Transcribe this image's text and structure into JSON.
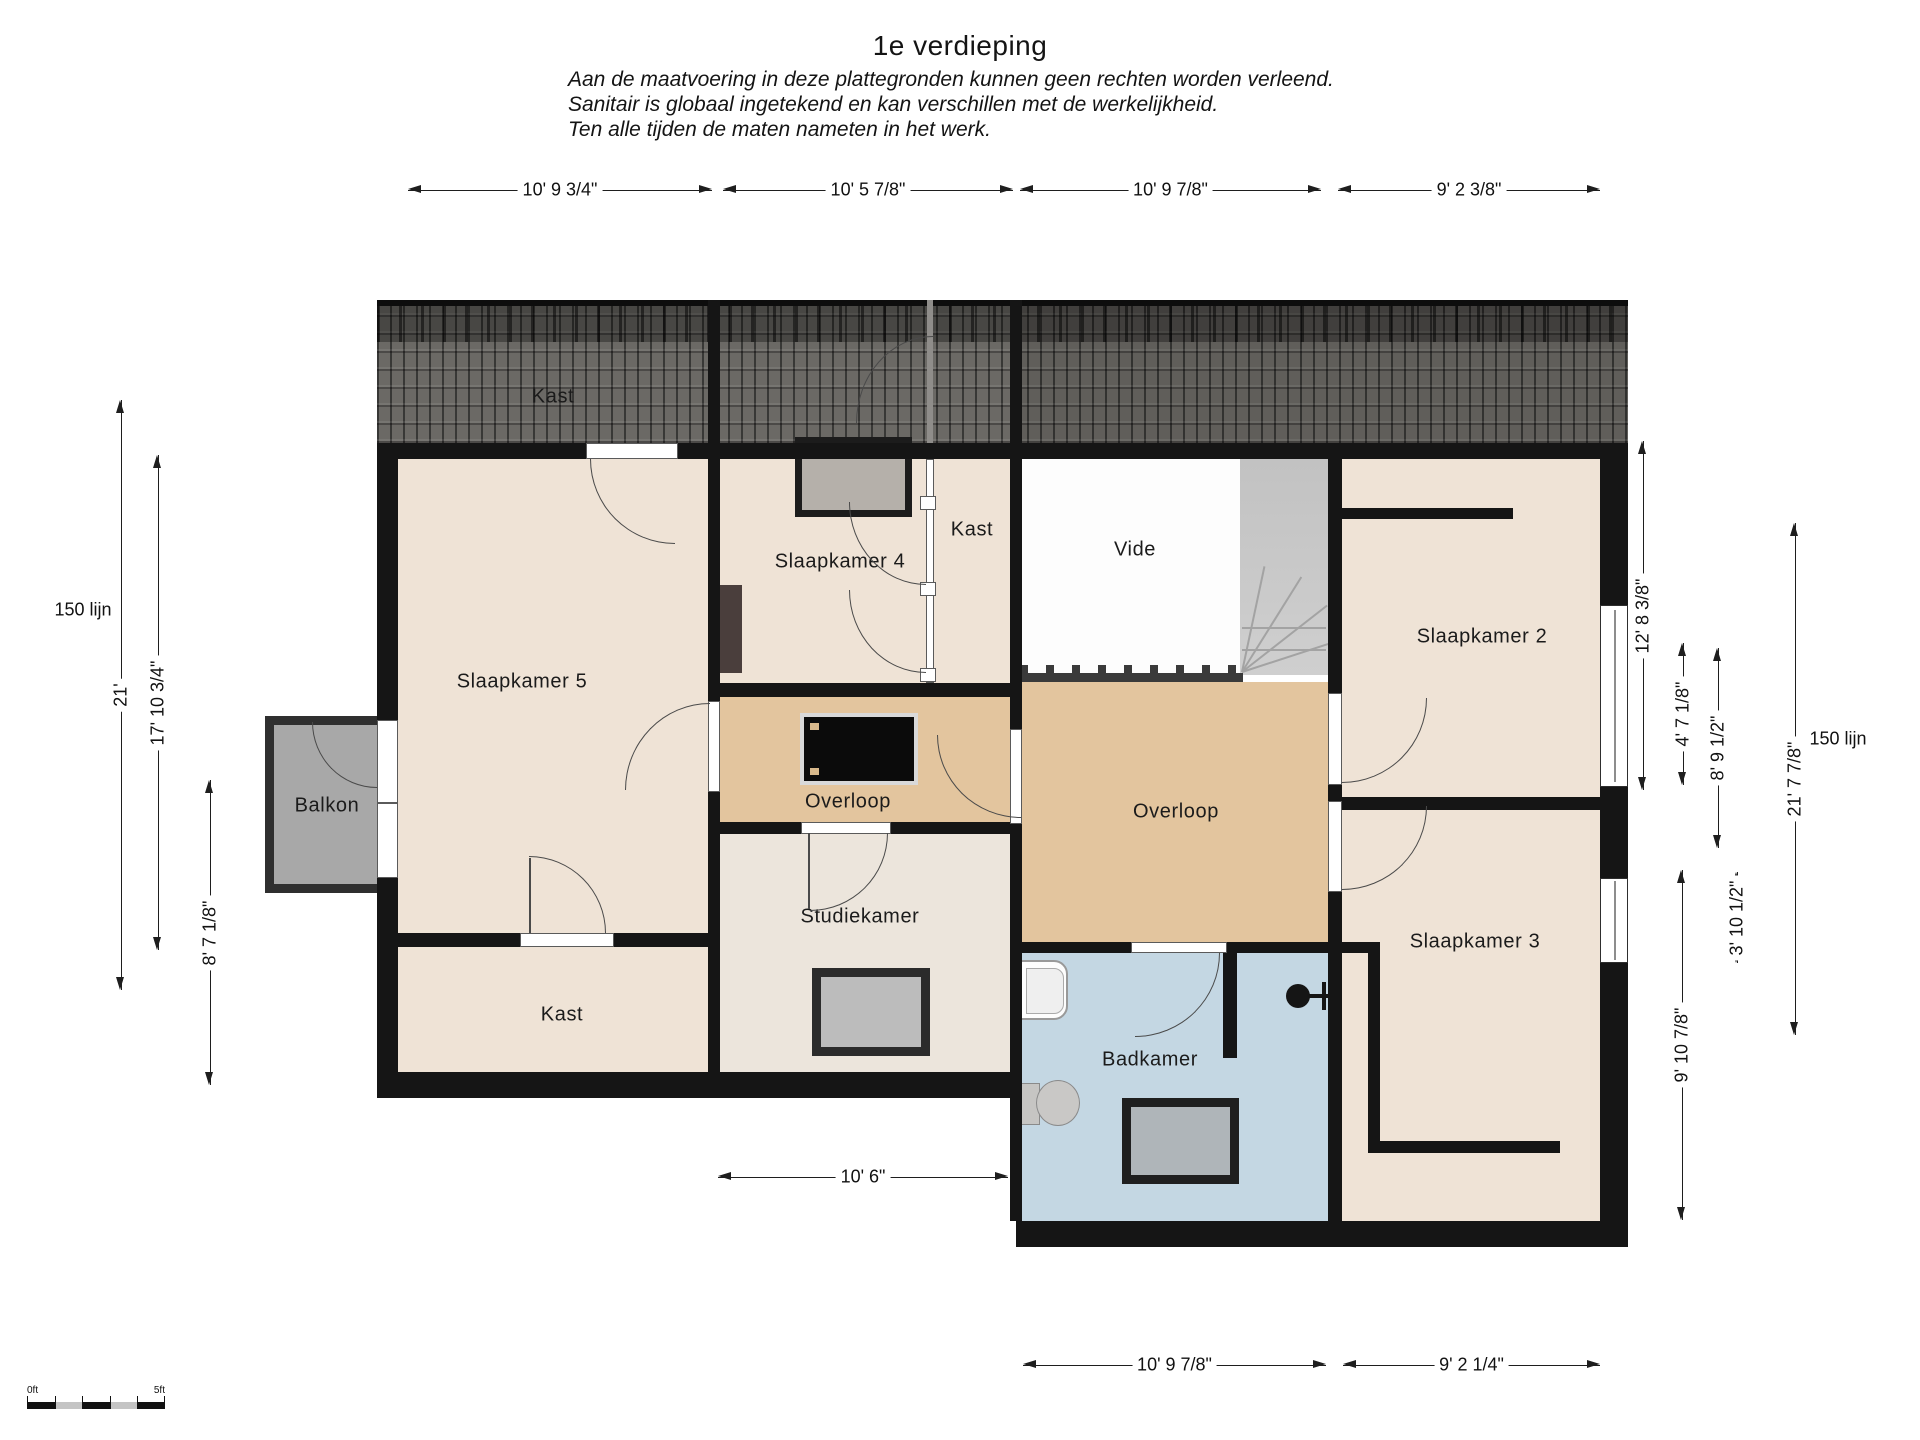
{
  "title": "1e verdieping",
  "disclaimer": {
    "line1": "Aan de maatvoering in deze plattegronden kunnen geen rechten worden verleend.",
    "line2": "Sanitair is globaal ingetekend en kan verschillen met de werkelijkheid.",
    "line3": "Ten alle tijden de maten nameten in het werk."
  },
  "rooms": {
    "roof_closet": "Kast",
    "bedroom5": "Slaapkamer 5",
    "bedroom4": "Slaapkamer 4",
    "closet_top": "Kast",
    "void": "Vide",
    "bedroom2": "Slaapkamer 2",
    "landing_left": "Overloop",
    "landing_right": "Overloop",
    "study": "Studiekamer",
    "closet_bottom": "Kast",
    "balcony": "Balkon",
    "bathroom": "Badkamer",
    "bedroom3": "Slaapkamer 3"
  },
  "dimensions": {
    "top": [
      {
        "id": "t1",
        "label": "10' 9 3/4\""
      },
      {
        "id": "t2",
        "label": "10' 5 7/8\""
      },
      {
        "id": "t3",
        "label": "10' 9 7/8\""
      },
      {
        "id": "t4",
        "label": "9' 2 3/8\""
      }
    ],
    "left": [
      {
        "id": "l1",
        "label": "21'"
      },
      {
        "id": "l2",
        "label": "17' 10 3/4\""
      },
      {
        "id": "l3",
        "label": "8' 7 1/8\""
      }
    ],
    "right": [
      {
        "id": "r1",
        "label": "12' 8 3/8\""
      },
      {
        "id": "r2",
        "label": "4' 7 1/8\""
      },
      {
        "id": "r3",
        "label": "8' 9 1/2\""
      },
      {
        "id": "r4",
        "label": "21' 7 7/8\""
      },
      {
        "id": "r5",
        "label": "3' 10 1/2\""
      },
      {
        "id": "r6",
        "label": "9' 10 7/8\""
      }
    ],
    "bottom": [
      {
        "id": "b1",
        "label": "10' 6\""
      },
      {
        "id": "b2",
        "label": "10' 9 7/8\""
      },
      {
        "id": "b3",
        "label": "9' 2 1/4\""
      }
    ],
    "left_line_label": "150 lijn",
    "right_line_label": "150 lijn"
  },
  "scale_bar": {
    "start_label": "0ft",
    "end_label": "5ft"
  },
  "colors": {
    "bedroom": "#efe3d6",
    "landing": "#e3c59e",
    "study": "#ece5dc",
    "bathroom": "#c4d7e3",
    "void": "#fdfdfd",
    "wall": "#151515"
  }
}
